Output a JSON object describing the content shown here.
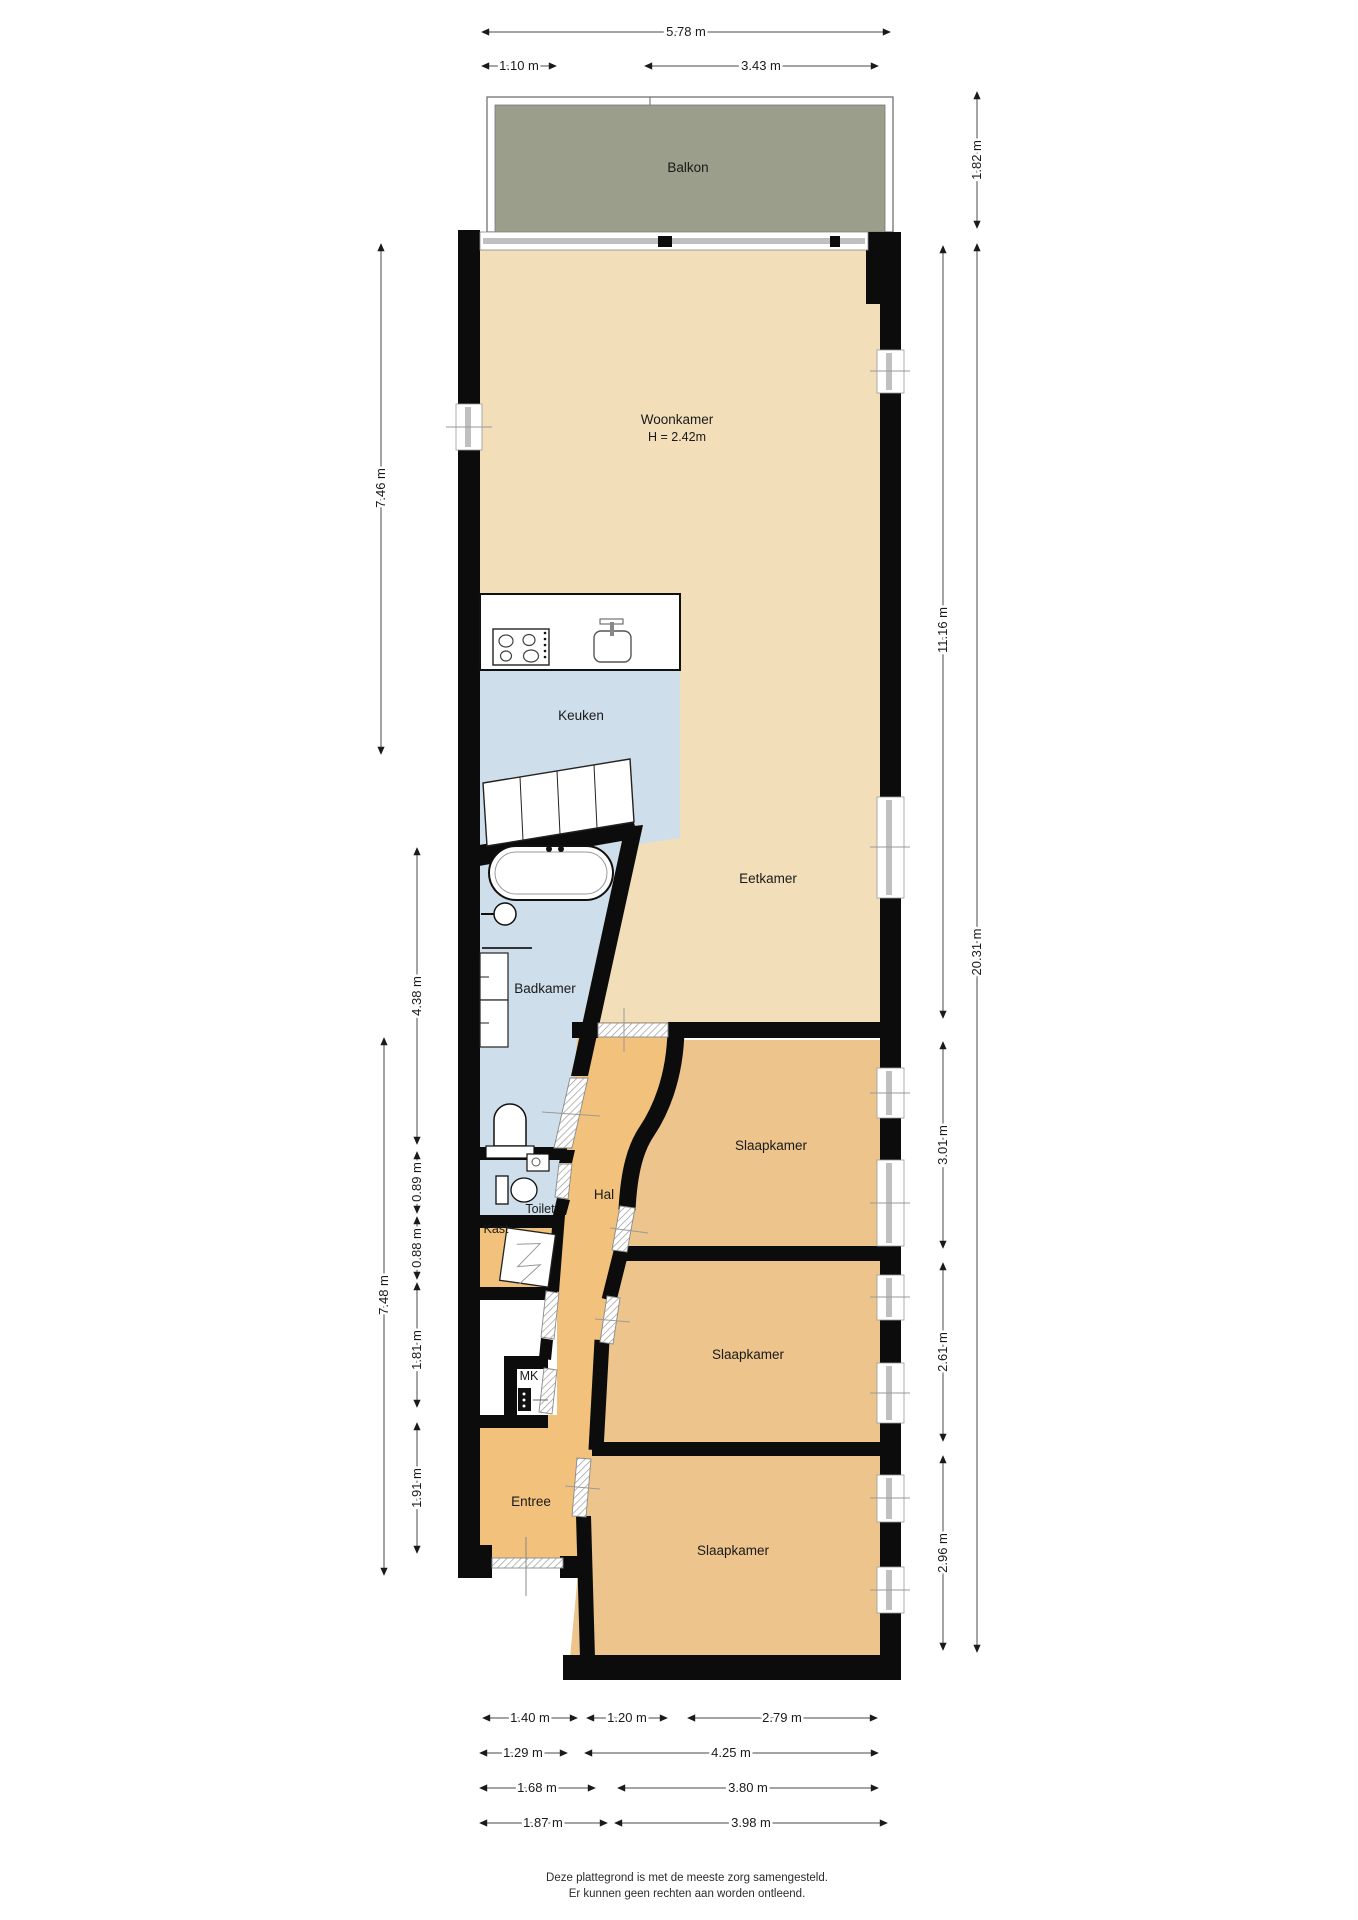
{
  "page": {
    "type": "floorplan",
    "background": "#ffffff"
  },
  "palette": {
    "wall": "#0c0c0c",
    "living_floor": "#f2dfba",
    "bedroom_floor": "#edc48c",
    "hall_floor": "#f2c27d",
    "wet_floor": "#cfdeeb",
    "balcony_floor": "#9a9e8b",
    "window_glass": "#c0c0c0",
    "dimension_text": "#1a1a1a"
  },
  "rooms": {
    "balkon": "Balkon",
    "woonkamer": "Woonkamer",
    "woonkamer_height": "H = 2.42m",
    "keuken": "Keuken",
    "eetkamer": "Eetkamer",
    "badkamer": "Badkamer",
    "toilet": "Toilet",
    "kast": "Kast",
    "hal": "Hal",
    "mk": "MK",
    "entree": "Entree",
    "slaapkamer_1": "Slaapkamer",
    "slaapkamer_2": "Slaapkamer",
    "slaapkamer_3": "Slaapkamer"
  },
  "dimensions": {
    "top": {
      "total": "5.78 m",
      "left": "1.10 m",
      "right": "3.43 m"
    },
    "right": {
      "balkon": "1.82 m",
      "upper": "11.16 m",
      "total": "20.31 m",
      "slaapkamer_1": "3.01 m",
      "slaapkamer_2": "2.61 m",
      "slaapkamer_3": "2.96 m"
    },
    "left": {
      "woonkamer": "7.46 m",
      "badkamer": "4.38 m",
      "toilet": "0.89 m",
      "kast": "0.88 m",
      "mid": "1.81 m",
      "entree": "1.91 m",
      "lower": "7.48 m"
    },
    "bottom": {
      "row1": [
        "1.40 m",
        "1.20 m",
        "2.79 m"
      ],
      "row2": [
        "1.29 m",
        "4.25 m"
      ],
      "row3": [
        "1.68 m",
        "3.80 m"
      ],
      "row4": [
        "1.87 m",
        "3.98 m"
      ]
    }
  },
  "footer": {
    "line1": "Deze plattegrond is met de meeste zorg samengesteld.",
    "line2": "Er kunnen geen rechten aan worden ontleend."
  }
}
